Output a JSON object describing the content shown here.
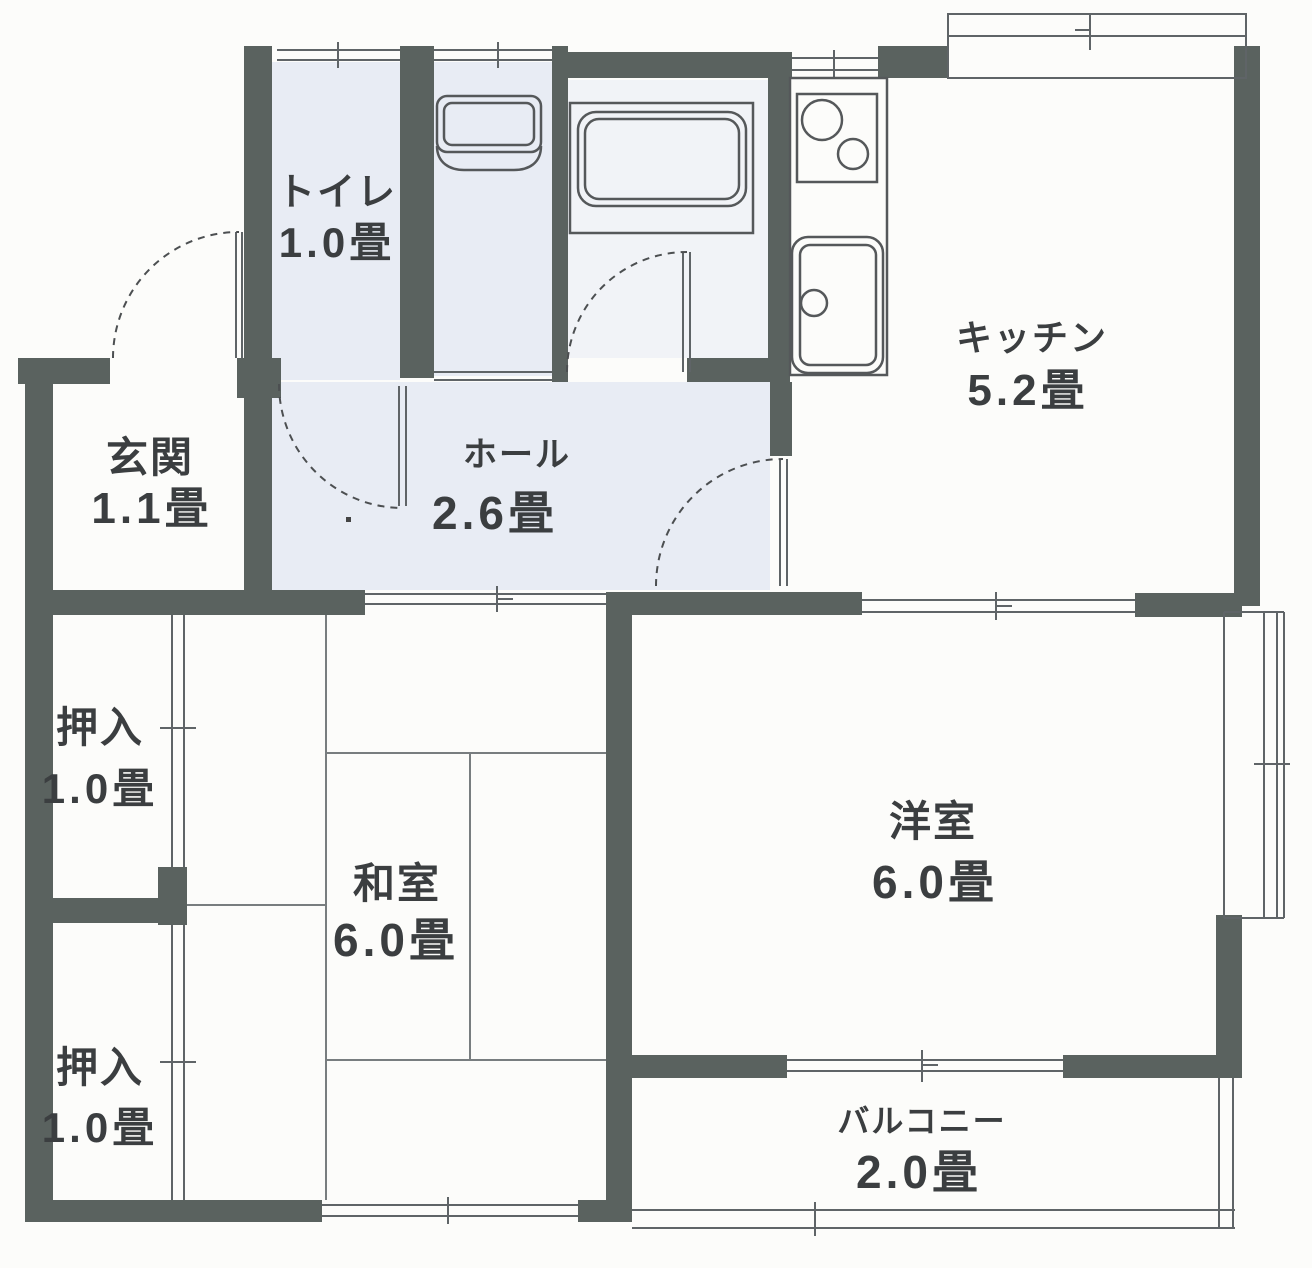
{
  "floorplan": {
    "type": "apartment-floor-plan",
    "wall_color": "#5a625f",
    "thin_line_color": "#5f6467",
    "room_tint_color": "#cdd7ec",
    "text_color": "#3b3e40",
    "rooms": {
      "toilet": {
        "name": "トイレ",
        "size": "1.0畳"
      },
      "entrance": {
        "name": "玄関",
        "size": "1.1畳"
      },
      "hall": {
        "name": "ホール",
        "size": "2.6畳"
      },
      "kitchen": {
        "name": "キッチン",
        "size": "5.2畳"
      },
      "closet_upper": {
        "name": "押入",
        "size": "1.0畳"
      },
      "closet_lower": {
        "name": "押入",
        "size": "1.0畳"
      },
      "japanese_room": {
        "name": "和室",
        "size": "6.0畳"
      },
      "western_room": {
        "name": "洋室",
        "size": "6.0畳"
      },
      "balcony": {
        "name": "バルコニー",
        "size": "2.0畳"
      }
    }
  }
}
